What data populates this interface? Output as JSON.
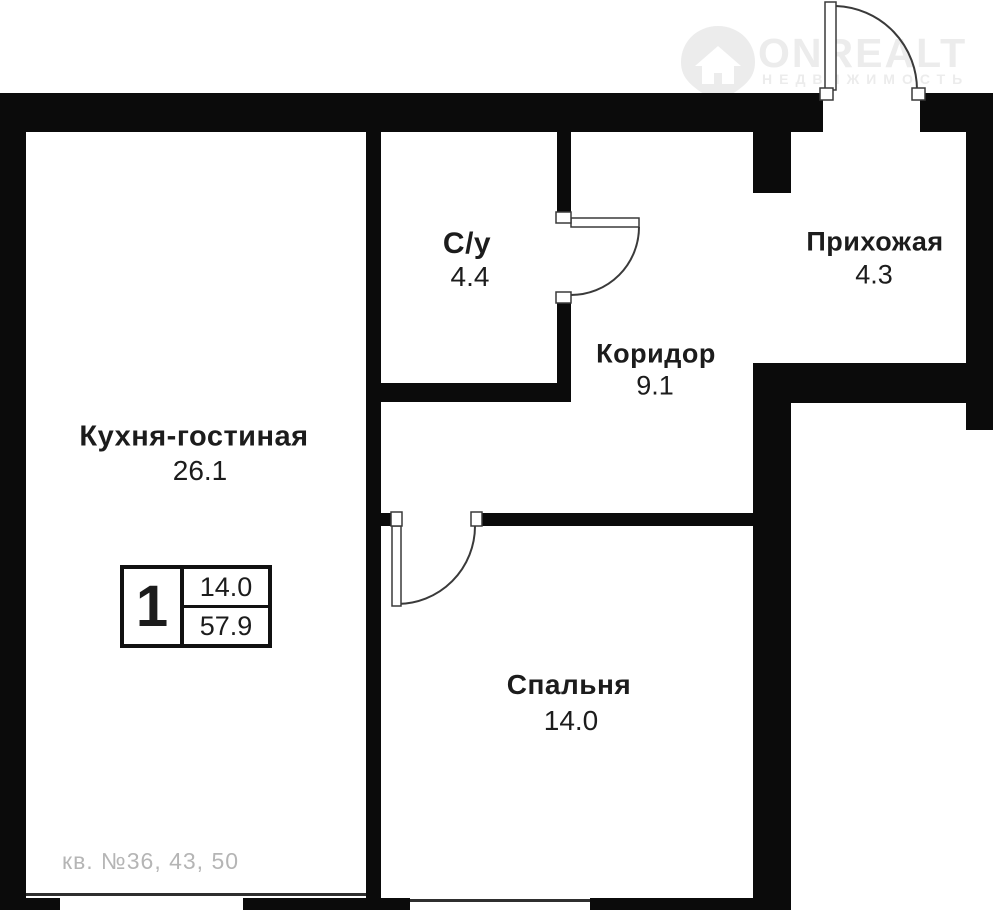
{
  "watermark": {
    "brand": "ONREALT",
    "subtitle": "НЕДВИЖИМОСТЬ"
  },
  "rooms": {
    "kitchen_living": {
      "name": "Кухня-гостиная",
      "area": "26.1"
    },
    "bathroom": {
      "name": "С/у",
      "area": "4.4"
    },
    "corridor": {
      "name": "Коридор",
      "area": "9.1"
    },
    "hallway": {
      "name": "Прихожая",
      "area": "4.3"
    },
    "bedroom": {
      "name": "Спальня",
      "area": "14.0"
    }
  },
  "legend": {
    "rooms_count": "1",
    "living_area": "14.0",
    "total_area": "57.9"
  },
  "apartment_note": "кв. №36, 43, 50",
  "colors": {
    "wall": "#0b0b0b",
    "text": "#1c1c1c",
    "watermark": "#ececec",
    "note_text": "#b5b5b5"
  }
}
